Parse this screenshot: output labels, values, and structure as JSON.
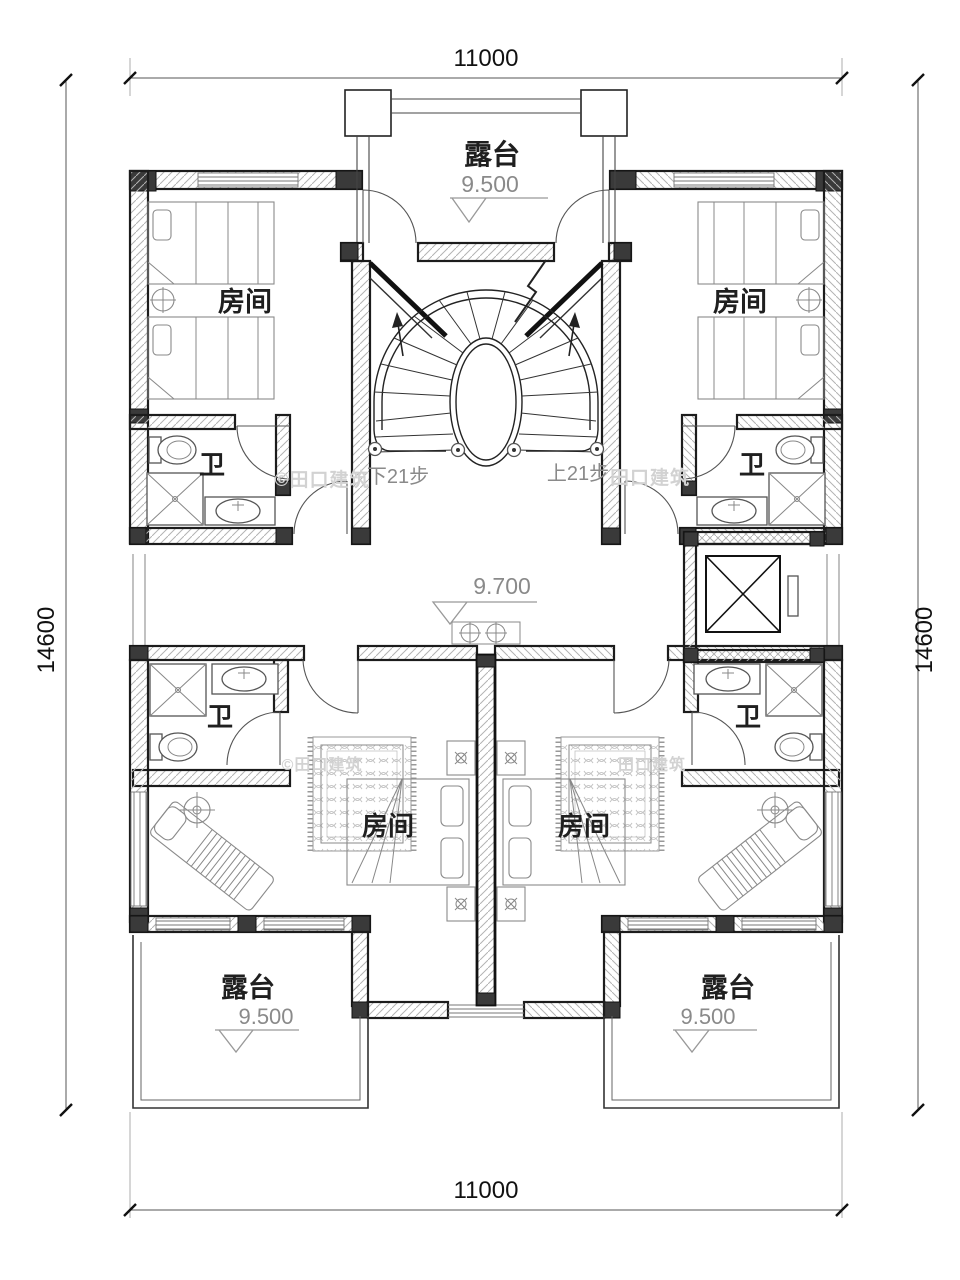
{
  "dimensions": {
    "top": "11000",
    "bottom": "11000",
    "left": "14600",
    "right": "14600"
  },
  "top_terrace": {
    "label": "露台",
    "level": "9.500"
  },
  "floor": {
    "level": "9.700"
  },
  "rooms": {
    "upper_left": {
      "label": "房间"
    },
    "upper_right": {
      "label": "房间"
    },
    "lower_left": {
      "label": "房间"
    },
    "lower_right": {
      "label": "房间"
    }
  },
  "bathrooms": {
    "upper_left": {
      "label": "卫"
    },
    "upper_right": {
      "label": "卫"
    },
    "lower_left": {
      "label": "卫"
    },
    "lower_right": {
      "label": "卫"
    }
  },
  "stairs": {
    "down_note": "下21步",
    "up_note": "上21步"
  },
  "bottom_terraces": {
    "left": {
      "label": "露台",
      "level": "9.500"
    },
    "right": {
      "label": "露台",
      "level": "9.500"
    }
  },
  "watermarks": {
    "w1": "©田口建筑",
    "w2": "田口建筑",
    "w3": "©田口建筑",
    "w4": "田口建筑"
  }
}
